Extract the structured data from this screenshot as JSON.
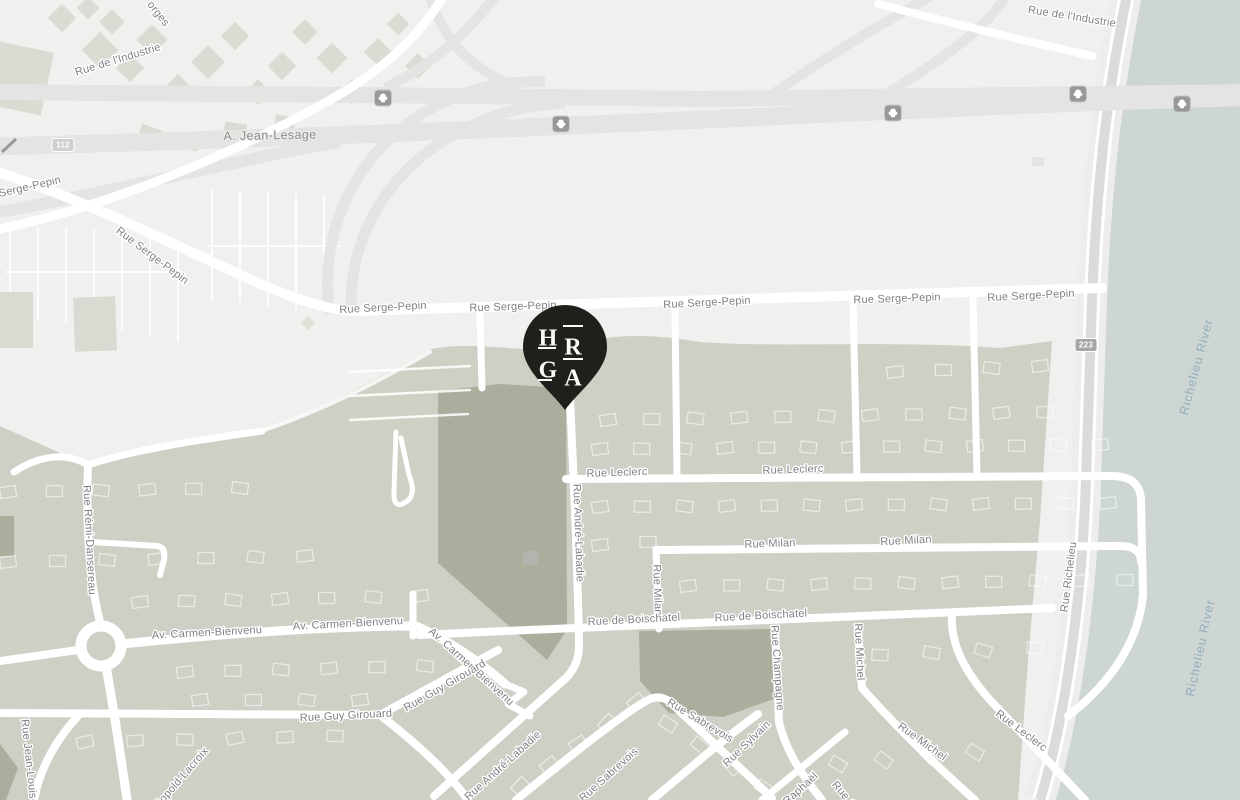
{
  "map": {
    "colors": {
      "background": "#f0f0ee",
      "residential": "#cdd0c5",
      "park": "#a9ae9d",
      "river": "#cdd6d3",
      "highway": "#e4e4e2",
      "road": "#ffffff",
      "gray_road": "#dbdbd9",
      "street_label": "#7d8085",
      "water_label": "#94adbd",
      "pin": "#211f1b"
    },
    "pin": {
      "letters": [
        "H",
        "R",
        "G",
        "A"
      ]
    },
    "labels": [
      {
        "text": "orges",
        "x": 158,
        "y": 14,
        "rot": 52,
        "kind": "street"
      },
      {
        "text": "Rue de l'Industrie",
        "x": 118,
        "y": 60,
        "rot": -17,
        "kind": "street"
      },
      {
        "text": "Rue de l'Industrie",
        "x": 1072,
        "y": 17,
        "rot": 9,
        "kind": "street"
      },
      {
        "text": "A. Jean-Lesage",
        "x": 270,
        "y": 136,
        "rot": -1,
        "kind": "hw"
      },
      {
        "text": "Serge-Pepin",
        "x": 30,
        "y": 187,
        "rot": -13,
        "kind": "street"
      },
      {
        "text": "Rue Serge-Pepin",
        "x": 152,
        "y": 256,
        "rot": 37,
        "kind": "street"
      },
      {
        "text": "Rue Serge-Pepin",
        "x": 383,
        "y": 308,
        "rot": -3,
        "kind": "street"
      },
      {
        "text": "Rue Serge-Pepin",
        "x": 513,
        "y": 307,
        "rot": -2,
        "kind": "street"
      },
      {
        "text": "Rue Serge-Pepin",
        "x": 707,
        "y": 303,
        "rot": -3,
        "kind": "street"
      },
      {
        "text": "Rue Serge-Pepin",
        "x": 897,
        "y": 299,
        "rot": -2,
        "kind": "street"
      },
      {
        "text": "Rue Serge-Pepin",
        "x": 1031,
        "y": 296,
        "rot": -3,
        "kind": "street"
      },
      {
        "text": "Rue Leclerc",
        "x": 617,
        "y": 473,
        "rot": -2,
        "kind": "street"
      },
      {
        "text": "Rue Leclerc",
        "x": 793,
        "y": 470,
        "rot": -2,
        "kind": "street"
      },
      {
        "text": "Rue Milan",
        "x": 770,
        "y": 544,
        "rot": -2,
        "kind": "street"
      },
      {
        "text": "Rue Milan",
        "x": 906,
        "y": 541,
        "rot": -3,
        "kind": "street"
      },
      {
        "text": "Rue Milan",
        "x": 657,
        "y": 590,
        "rot": 88,
        "kind": "street"
      },
      {
        "text": "Rue de Boischatel",
        "x": 634,
        "y": 620,
        "rot": -3,
        "kind": "street"
      },
      {
        "text": "Rue de Boischatel",
        "x": 761,
        "y": 616,
        "rot": -3,
        "kind": "street"
      },
      {
        "text": "Rue André-Labadie",
        "x": 578,
        "y": 533,
        "rot": 88,
        "kind": "street"
      },
      {
        "text": "Rue Champagne",
        "x": 777,
        "y": 668,
        "rot": 86,
        "kind": "street"
      },
      {
        "text": "Rue Michel",
        "x": 859,
        "y": 652,
        "rot": 87,
        "kind": "street"
      },
      {
        "text": "Rue Michel",
        "x": 922,
        "y": 742,
        "rot": 36,
        "kind": "street"
      },
      {
        "text": "Rue Leclerc",
        "x": 1021,
        "y": 731,
        "rot": 37,
        "kind": "street"
      },
      {
        "text": "Rue Richelieu",
        "x": 1069,
        "y": 577,
        "rot": -83,
        "kind": "street"
      },
      {
        "text": "Richelieu River",
        "x": 1197,
        "y": 367,
        "rot": -75,
        "kind": "water"
      },
      {
        "text": "Richelieu River",
        "x": 1201,
        "y": 648,
        "rot": -78,
        "kind": "water"
      },
      {
        "text": "Av. Carmen-Bienvenu",
        "x": 207,
        "y": 633,
        "rot": -3,
        "kind": "street"
      },
      {
        "text": "Av. Carmen-Bienvenu",
        "x": 348,
        "y": 624,
        "rot": -3,
        "kind": "street"
      },
      {
        "text": "Av. Carmen-Bienvenu",
        "x": 471,
        "y": 667,
        "rot": 42,
        "kind": "street"
      },
      {
        "text": "Rue Rémi-Dansereau",
        "x": 89,
        "y": 540,
        "rot": 87,
        "kind": "street"
      },
      {
        "text": "Rue Guy Girouard",
        "x": 346,
        "y": 716,
        "rot": -3,
        "kind": "street"
      },
      {
        "text": "Rue Guy Girouard",
        "x": 445,
        "y": 686,
        "rot": -30,
        "kind": "street"
      },
      {
        "text": "Rue André-Labadie",
        "x": 503,
        "y": 766,
        "rot": -42,
        "kind": "street"
      },
      {
        "text": "Rue Sabrevois",
        "x": 700,
        "y": 721,
        "rot": 31,
        "kind": "street"
      },
      {
        "text": "Rue Sabrevois",
        "x": 609,
        "y": 775,
        "rot": -42,
        "kind": "street"
      },
      {
        "text": "Rue Sylvain",
        "x": 747,
        "y": 744,
        "rot": -44,
        "kind": "street"
      },
      {
        "text": "Rue Raphaël",
        "x": 792,
        "y": 797,
        "rot": -42,
        "kind": "street"
      },
      {
        "text": "Rue Cha",
        "x": 848,
        "y": 800,
        "rot": 50,
        "kind": "street"
      },
      {
        "text": "Rue Jean-Louis-L",
        "x": 29,
        "y": 764,
        "rot": 84,
        "kind": "street"
      },
      {
        "text": "Léopold-Lacroix",
        "x": 180,
        "y": 780,
        "rot": -49,
        "kind": "street"
      }
    ],
    "shields": {
      "autoroute_positions": [
        {
          "x": 383,
          "y": 98
        },
        {
          "x": 561,
          "y": 124
        },
        {
          "x": 893,
          "y": 113
        },
        {
          "x": 1078,
          "y": 94
        },
        {
          "x": 1182,
          "y": 104
        }
      ],
      "routes": [
        {
          "num": "112",
          "x": 63,
          "y": 145,
          "bg": "#cfcfcd"
        },
        {
          "num": "223",
          "x": 1086,
          "y": 345,
          "bg": "#a6a6a4"
        }
      ]
    }
  }
}
